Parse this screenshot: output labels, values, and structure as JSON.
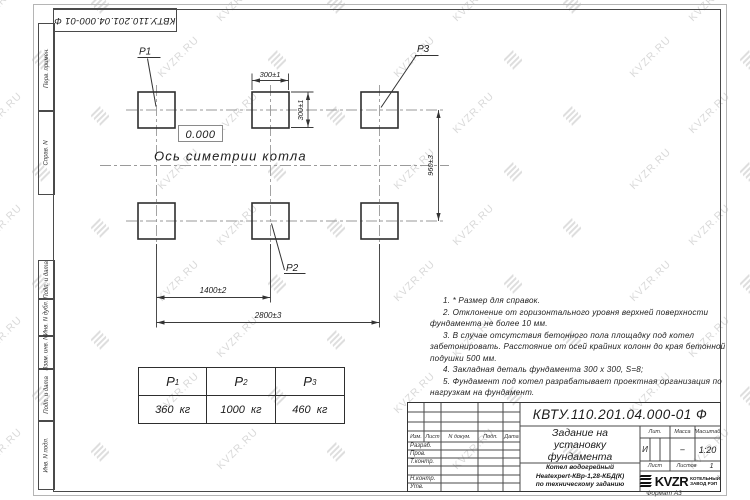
{
  "doc_number": "КВТУ.110.201.04.000-01  Ф",
  "watermark": {
    "text": "KVZR.RU"
  },
  "margin": {
    "labels": [
      "Перв. примен.",
      "Справ. N",
      "Подп. и дата",
      "Инв. N дубл.",
      "Взам. инв. N",
      "Подп. и дата",
      "Инв. N подл."
    ]
  },
  "drawing": {
    "pad_labels": {
      "p1": "P1",
      "p2": "P2",
      "p3": "P3"
    },
    "level_mark": "0.000",
    "axis_label": "Ось симетрии котла",
    "dims": {
      "pad_width": "300±1",
      "pad_depth": "300±1",
      "row_spacing": "960±3",
      "column_spacing": "1400±2",
      "total_span": "2800±3"
    }
  },
  "notes": [
    "1.  * Размер для справок.",
    "2.  Отклонение от горизонтального уровня верхней поверхности фундамента не более 10 мм.",
    "3.  В случае отсутствия бетонного пола площадку под котел забетонировать. Расстояние от осей крайних колонн до края бетонной подушки 500 мм.",
    "4.  Закладная деталь фундамента  300 х 300, S=8;",
    "5.  Фундамент под котел разрабатывает проектная организация по нагрузкам на фундамент."
  ],
  "load_table": {
    "headers": [
      {
        "base": "P",
        "sub": "1"
      },
      {
        "base": "P",
        "sub": "2"
      },
      {
        "base": "P",
        "sub": "3"
      }
    ],
    "values": [
      "360  кг",
      "1000  кг",
      "460  кг"
    ]
  },
  "title_block": {
    "title_lines": [
      "Задание на",
      "установку",
      "фундамента"
    ],
    "subtitle_lines": [
      "Котел водогрейный",
      "Heatexpert-КВр-1,28-КБД(К)",
      "по техническому заданию"
    ],
    "col_headers": {
      "izm": "Изм.",
      "list": "Лист",
      "ndoc": "N докум.",
      "podp": "Подп.",
      "data": "Дата"
    },
    "row_labels": [
      "Разраб.",
      "Пров.",
      "Т.контр.",
      "",
      "Н.контр.",
      "Утв."
    ],
    "lit_header": "Лит.",
    "mass_header": "Масса",
    "scale_header": "Масштаб",
    "lit_value": "И",
    "mass_value": "–",
    "scale_value": "1:20",
    "sheet_label": "Лист",
    "sheets_label": "Листов",
    "sheets_value": "1",
    "logo_text": "KVZR",
    "logo_caption_lines": [
      "КОТЕЛЬНЫЙ",
      "ЗАВОД РЭП"
    ],
    "format_label": "Формат А3"
  }
}
